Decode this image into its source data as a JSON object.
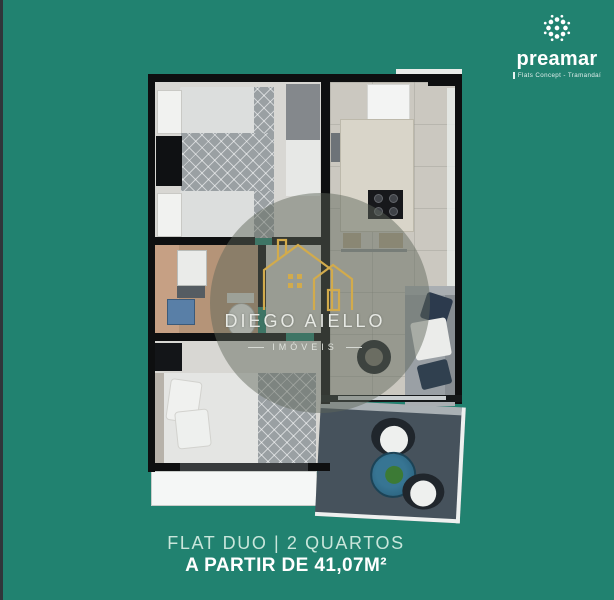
{
  "colors": {
    "background_teal": "#218270",
    "accent_gold": "#d2ab4c",
    "caption_secondary": "#c9e6db",
    "caption_primary": "#ffffff",
    "wall_black": "#0e0f10",
    "balcony_floor": "#46525c"
  },
  "brand": {
    "name": "preamar",
    "tagline": "Flats Concept - Tramandaí",
    "icon": "rosette-icon"
  },
  "watermark": {
    "title": "DIEGO AIELLO",
    "subtitle": "IMÓVEIS",
    "icon": "double-house-icon"
  },
  "caption": {
    "line1": "FLAT DUO | 2 QUARTOS",
    "line2": "A PARTIR DE 41,07M²"
  },
  "floorplan": {
    "rooms": [
      "bedroom-1",
      "bathroom",
      "hallway",
      "bedroom-2",
      "kitchen",
      "living-room",
      "balcony",
      "terrace"
    ]
  }
}
